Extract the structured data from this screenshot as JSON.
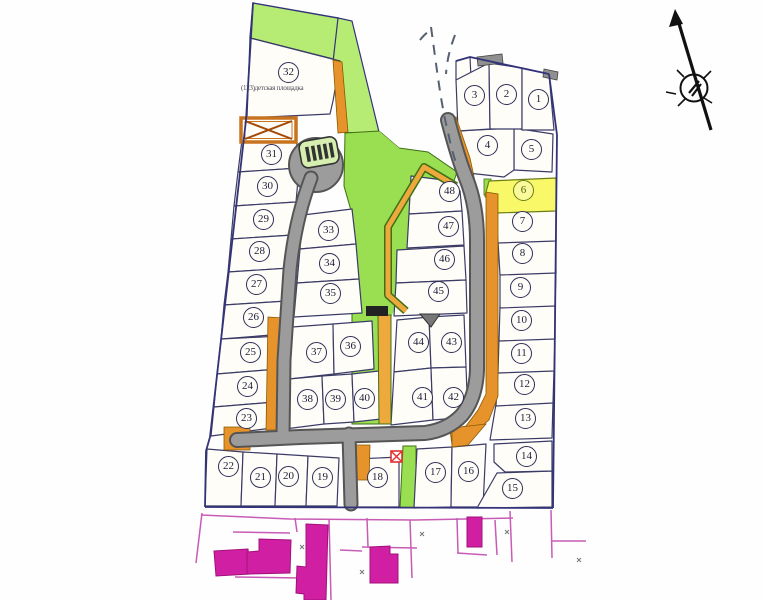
{
  "map": {
    "kind": "cadastral site plan with numbered parcels",
    "lot32_annotation": "(123)детская площадка",
    "highlighted_lot": "6",
    "colors": {
      "green_area": "#9ade52",
      "green_band": "#b7ec74",
      "highlight_yellow": "#f9f868",
      "road_gray": "#a0a0a0",
      "road_casing": "#555555",
      "orange_edge": "#e6932c",
      "boundary_navy": "#33337a",
      "existing_buildings_magenta": "#d11fa3",
      "red_mark": "#e03030"
    },
    "symbols": {
      "north_arrow": "north-arrow",
      "orange_crossed_box": "transformer-crossed-box",
      "red_crossed_box": "small-red-crossed-box",
      "hatched_structure": "hatched-structure-in-culdesac",
      "dashed_stream": "dashed-stream-lines"
    }
  },
  "lots": [
    {
      "label": "1"
    },
    {
      "label": "2"
    },
    {
      "label": "3"
    },
    {
      "label": "4"
    },
    {
      "label": "5"
    },
    {
      "label": "6"
    },
    {
      "label": "7"
    },
    {
      "label": "8"
    },
    {
      "label": "9"
    },
    {
      "label": "10"
    },
    {
      "label": "11"
    },
    {
      "label": "12"
    },
    {
      "label": "13"
    },
    {
      "label": "14"
    },
    {
      "label": "15"
    },
    {
      "label": "16"
    },
    {
      "label": "17"
    },
    {
      "label": "18"
    },
    {
      "label": "19"
    },
    {
      "label": "20"
    },
    {
      "label": "21"
    },
    {
      "label": "22"
    },
    {
      "label": "23"
    },
    {
      "label": "24"
    },
    {
      "label": "25"
    },
    {
      "label": "26"
    },
    {
      "label": "27"
    },
    {
      "label": "28"
    },
    {
      "label": "29"
    },
    {
      "label": "30"
    },
    {
      "label": "31"
    },
    {
      "label": "32"
    },
    {
      "label": "33"
    },
    {
      "label": "34"
    },
    {
      "label": "35"
    },
    {
      "label": "36"
    },
    {
      "label": "37"
    },
    {
      "label": "38"
    },
    {
      "label": "39"
    },
    {
      "label": "40"
    },
    {
      "label": "41"
    },
    {
      "label": "42"
    },
    {
      "label": "43"
    },
    {
      "label": "44"
    },
    {
      "label": "45"
    },
    {
      "label": "46"
    },
    {
      "label": "47"
    },
    {
      "label": "48"
    }
  ]
}
